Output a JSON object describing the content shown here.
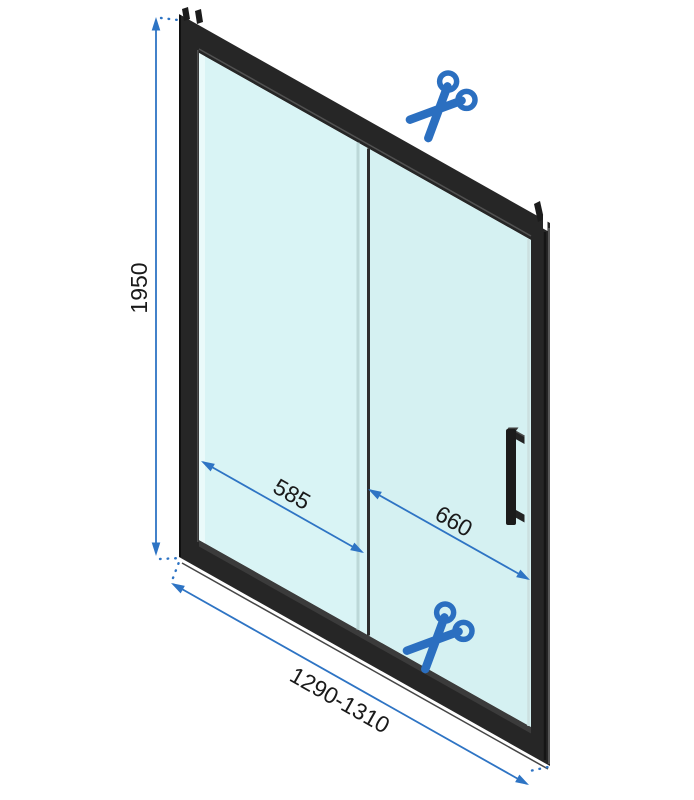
{
  "diagram": {
    "type": "shower-door-technical-drawing",
    "dimensions": {
      "height": "1950",
      "fixed_panel_width": "585",
      "door_panel_width": "660",
      "total_width_range": "1290-1310"
    },
    "icons": {
      "top": "scissors-icon",
      "bottom": "scissors-icon"
    },
    "colors": {
      "accent": "#2e74c4",
      "scissors": "#2b6fc0",
      "frame": "#262626",
      "glass-fixed": "#d9f4f5",
      "glass-sliding": "#d5f1f2",
      "label-text": "#1a1a1a",
      "background": "#ffffff"
    }
  }
}
